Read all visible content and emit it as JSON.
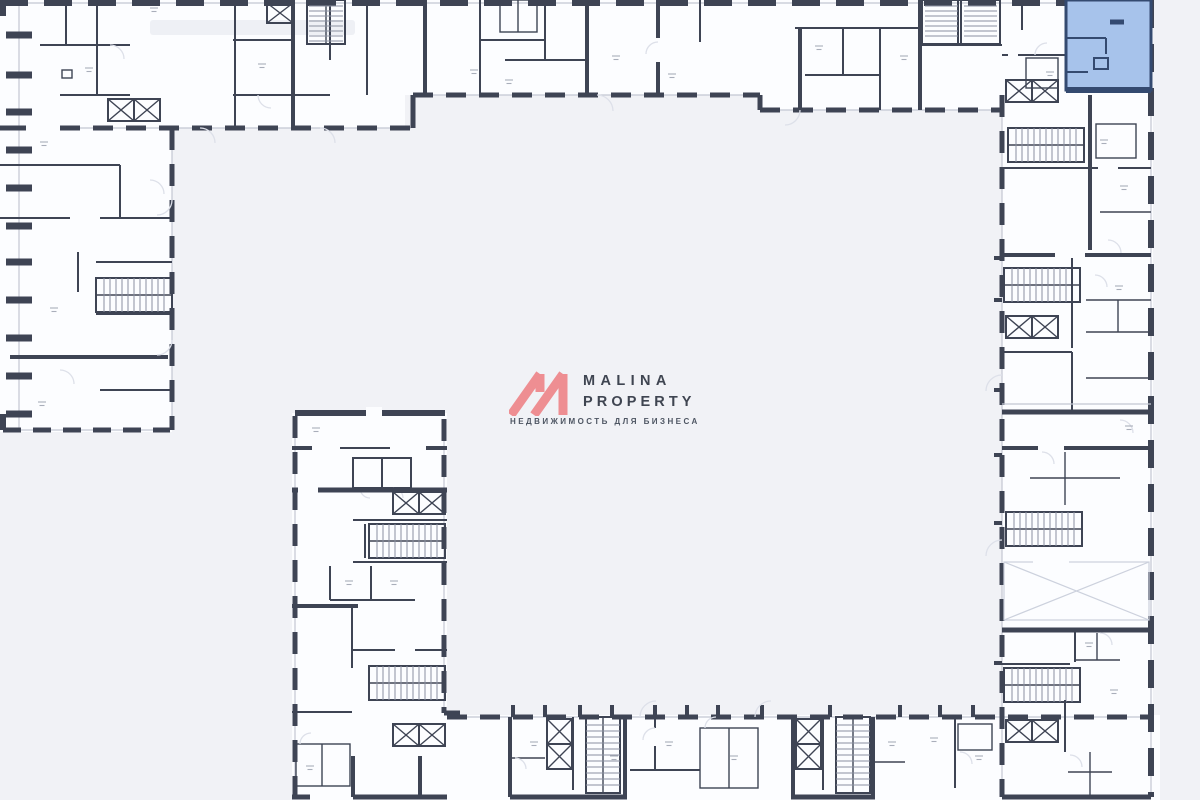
{
  "logo": {
    "line1": "MALINA",
    "line2": "PROPERTY",
    "tagline": "НЕДВИЖИМОСТЬ ДЛЯ БИЗНЕСА"
  },
  "plan": {
    "highlighted_unit_location": "top-right"
  },
  "colors": {
    "bg": "#f1f2f6",
    "interior": "#fcfdff",
    "ink": "#3e4454",
    "sill": "#c3c7d2",
    "arc": "#dde0e9",
    "label": "#a9aeba",
    "blue-fill": "#a7c3eb",
    "blue-wall": "#344a70",
    "pink": "#ee8e92",
    "brand-text": "#3f4551",
    "tagline-text": "#4e5663"
  }
}
